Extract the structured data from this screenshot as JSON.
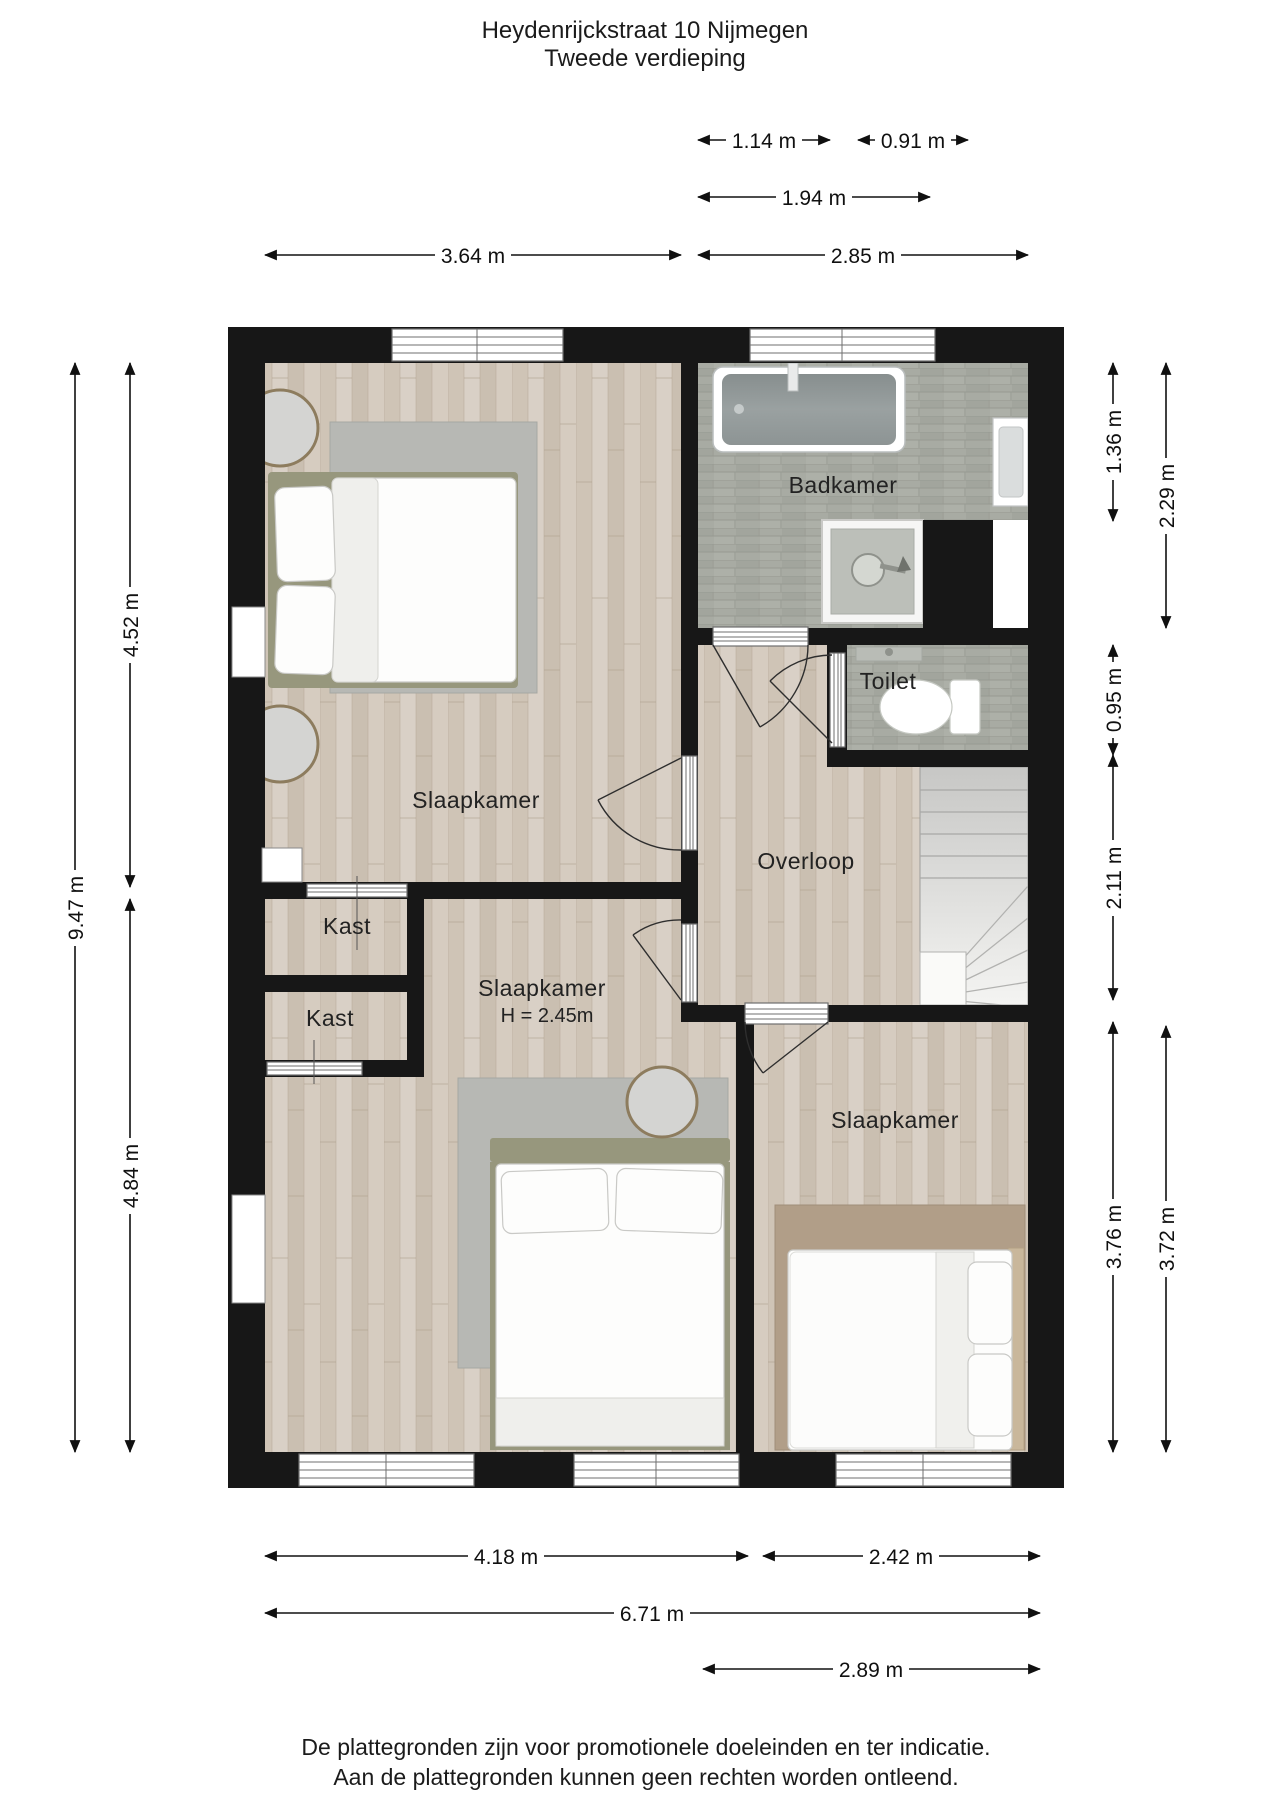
{
  "title": {
    "line1": "Heydenrijckstraat 10 Nijmegen",
    "line2": "Tweede verdieping"
  },
  "rooms": {
    "badkamer": "Badkamer",
    "toilet": "Toilet",
    "overloop": "Overloop",
    "slaapkamer1": "Slaapkamer",
    "kast1": "Kast",
    "kast2": "Kast",
    "slaapkamer2": "Slaapkamer",
    "slaapkamer2_height": "H = 2.45m",
    "slaapkamer3": "Slaapkamer"
  },
  "dims": {
    "d114": "1.14 m",
    "d091": "0.91 m",
    "d194": "1.94 m",
    "d364": "3.64 m",
    "d285": "2.85 m",
    "d452": "4.52 m",
    "d947": "9.47 m",
    "d484": "4.84 m",
    "d136": "1.36 m",
    "d229": "2.29 m",
    "d095": "0.95 m",
    "d211": "2.11 m",
    "d376": "3.76 m",
    "d372": "3.72 m",
    "d418": "4.18 m",
    "d242": "2.42 m",
    "d671": "6.71 m",
    "d289": "2.89 m"
  },
  "footer": {
    "line1": "De plattegronden zijn voor promotionele doeleinden en ter indicatie.",
    "line2": "Aan de plattegronden kunnen geen rechten worden ontleend."
  },
  "colors": {
    "wall": "#171717",
    "floor_wood": "#d4cabf",
    "floor_tile": "#a8aba3",
    "rug_gray": "#b7b8b4",
    "rug_tan": "#b19e88",
    "stairs": "#dededc",
    "text": "#222222",
    "background": "#ffffff"
  }
}
